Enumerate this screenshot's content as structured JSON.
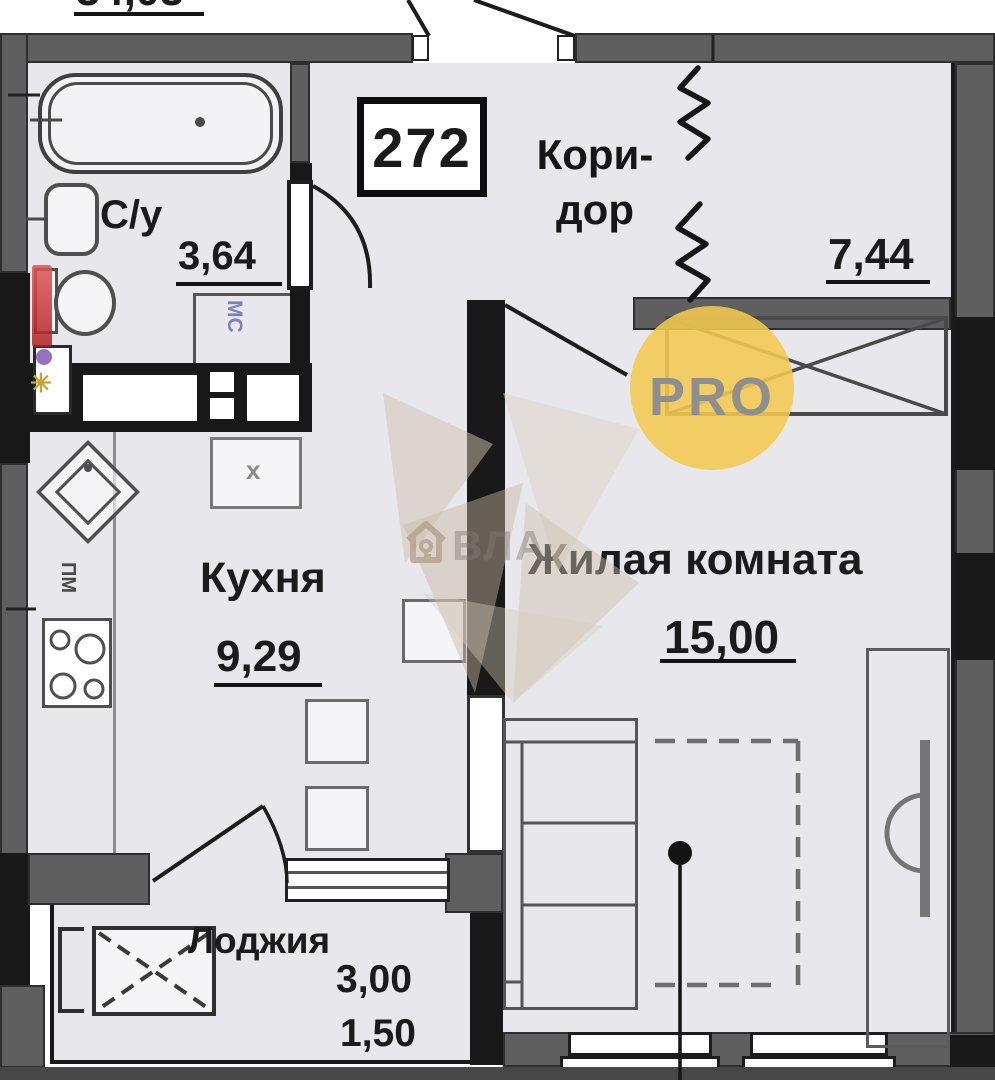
{
  "plan": {
    "total_dimension": "34,03",
    "unit_number": "272",
    "rooms": {
      "bathroom": {
        "name": "С/у",
        "area": "3,64"
      },
      "corridor": {
        "name_line1": "Кори-",
        "name_line2": "дор",
        "area": "7,44"
      },
      "kitchen": {
        "name": "Кухня",
        "area": "9,29"
      },
      "living": {
        "name": "Жилая комната",
        "area": "15,00"
      },
      "loggia": {
        "name": "Лоджия",
        "area_full": "3,00",
        "area_reduced": "1,50"
      }
    },
    "labels": {
      "washing_machine": "МС",
      "dishwasher": "ПМ",
      "closet": "х"
    }
  },
  "watermarks": {
    "pro_badge": "PRO",
    "agency_text": "ВЛА"
  },
  "colors": {
    "wall_gray": "#5f5f5f",
    "wall_black": "#181818",
    "floor": "#e7e7ec",
    "accent_yellow": "#f4ca51",
    "riser_red": "#c73535",
    "label_blue": "#8080c0"
  }
}
